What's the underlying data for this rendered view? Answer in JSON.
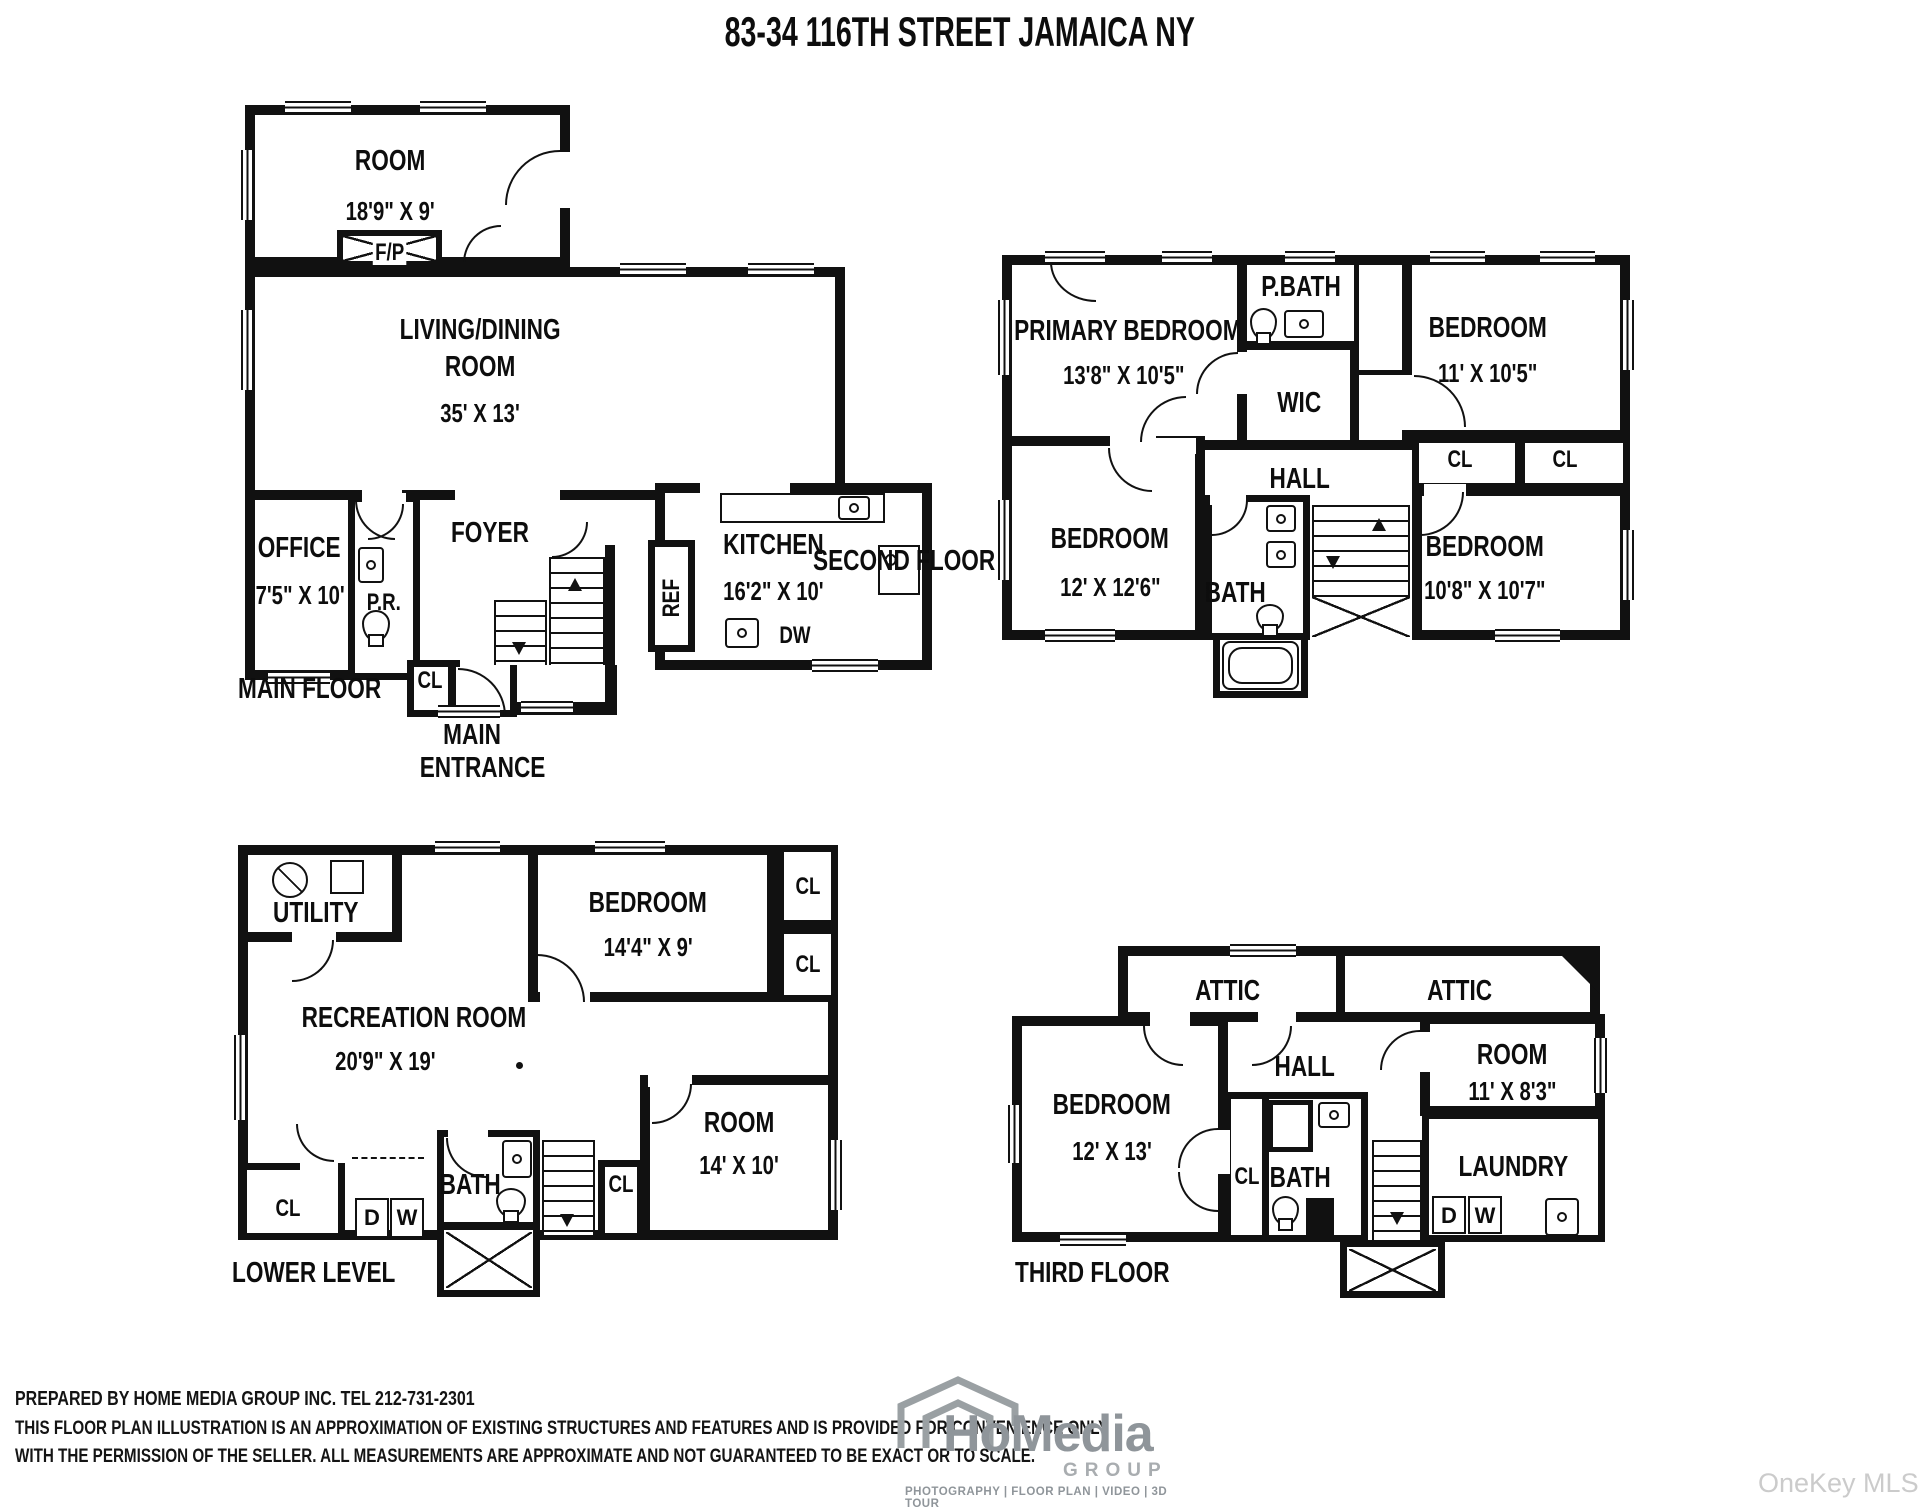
{
  "title": "83-34 116TH STREET JAMAICA NY",
  "watermark": "OneKey MLS",
  "floors": {
    "main": {
      "label": "MAIN FLOOR",
      "room": {
        "name": "ROOM",
        "dims": "18'9\" X 9'"
      },
      "fireplace": "F/P",
      "living": {
        "line1": "LIVING/DINING",
        "line2": "ROOM",
        "dims": "35' X 13'"
      },
      "office": {
        "name": "OFFICE",
        "dims": "7'5\" X 10'"
      },
      "powder_room": "P.R.",
      "foyer": "FOYER",
      "closet": "CL",
      "entrance": {
        "line1": "MAIN",
        "line2": "ENTRANCE"
      },
      "kitchen": {
        "name": "KITCHEN",
        "dims": "16'2\" X 10'"
      },
      "fridge": "REF",
      "dishwasher": "DW"
    },
    "second": {
      "label": "SECOND FLOOR",
      "primary": {
        "name": "PRIMARY BEDROOM",
        "dims": "13'8\" X 10'5\""
      },
      "pbath": "P.BATH",
      "wic": "WIC",
      "bedroom2": {
        "name": "BEDROOM",
        "dims": "11' X 10'5\""
      },
      "hall": "HALL",
      "closet1": "CL",
      "closet2": "CL",
      "bedroom3": {
        "name": "BEDROOM",
        "dims": "12' X 12'6\""
      },
      "bath": "BATH",
      "bedroom4": {
        "name": "BEDROOM",
        "dims": "10'8\" X 10'7\""
      }
    },
    "lower": {
      "label": "LOWER LEVEL",
      "utility": "UTILITY",
      "bedroom": {
        "name": "BEDROOM",
        "dims": "14'4\" X 9'"
      },
      "closet1": "CL",
      "closet2": "CL",
      "recreation": {
        "name": "RECREATION ROOM",
        "dims": "20'9\" X 19'"
      },
      "room": {
        "name": "ROOM",
        "dims": "14' X 10'"
      },
      "bath": "BATH",
      "closet3": "CL",
      "dryer": "D",
      "washer": "W",
      "closet4": "CL"
    },
    "third": {
      "label": "THIRD FLOOR",
      "attic1": "ATTIC",
      "attic2": "ATTIC",
      "bedroom": {
        "name": "BEDROOM",
        "dims": "12' X 13'"
      },
      "hall": "HALL",
      "room": {
        "name": "ROOM",
        "dims": "11' X 8'3\""
      },
      "closet": "CL",
      "bath": "BATH",
      "laundry": "LAUNDRY",
      "dryer": "D",
      "washer": "W"
    }
  },
  "footer": {
    "line1": "PREPARED BY  HOME MEDIA GROUP INC.  TEL 212-731-2301",
    "line2": "THIS FLOOR PLAN ILLUSTRATION IS AN APPROXIMATION OF EXISTING STRUCTURES AND FEATURES AND IS PROVIDED FOR CONVENIENCE ONLY",
    "line3": "WITH THE PERMISSION OF THE SELLER. ALL MEASUREMENTS ARE APPROXIMATE AND NOT GUARANTEED TO BE EXACT OR TO SCALE."
  },
  "logo": {
    "name": "HoMedia",
    "group": "GROUP",
    "services": "PHOTOGRAPHY | FLOOR PLAN | VIDEO | 3D TOUR"
  }
}
